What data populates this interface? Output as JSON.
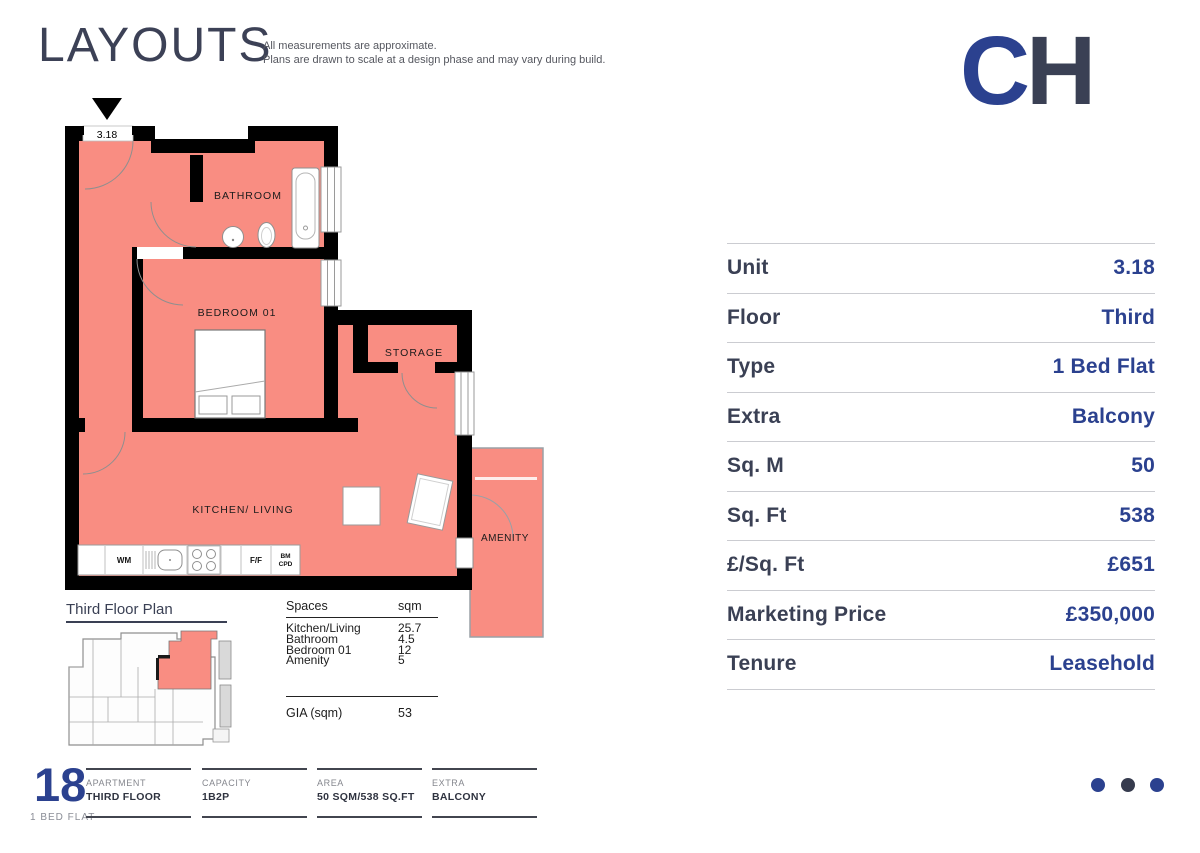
{
  "header": {
    "title": "LAYOUTS",
    "disclaimer_line1": "All measurements are approximate.",
    "disclaimer_line2": "Plans are drawn to scale at a design phase and may vary during build."
  },
  "logo": {
    "c": "C",
    "h": "H",
    "c_color": "#2B418F",
    "h_color": "#3A4054"
  },
  "plan": {
    "unit_label": "3.18",
    "fill_color": "#F98D82",
    "rooms": {
      "bathroom": "BATHROOM",
      "bedroom": "BEDROOM 01",
      "storage": "STORAGE",
      "kitchen": "KITCHEN/ LIVING",
      "amenity": "AMENITY"
    },
    "fixtures": {
      "wm": "WM",
      "ff": "F/F",
      "bm": "BM",
      "cpd": "CPD"
    }
  },
  "key_plan": {
    "title": "Third Floor Plan"
  },
  "spaces_table": {
    "header_label": "Spaces",
    "header_unit": "sqm",
    "rows": [
      {
        "name": "Kitchen/Living",
        "sqm": "25.7"
      },
      {
        "name": "Bathroom",
        "sqm": "4.5"
      },
      {
        "name": "Bedroom 01",
        "sqm": "12"
      },
      {
        "name": "Amenity",
        "sqm": "5"
      }
    ],
    "gia_label": "GIA (sqm)",
    "gia_value": "53"
  },
  "details_table": {
    "label_color": "#3A4054",
    "value_color": "#2B418F",
    "rows": [
      {
        "label": "Unit",
        "value": "3.18"
      },
      {
        "label": "Floor",
        "value": "Third"
      },
      {
        "label": "Type",
        "value": "1 Bed Flat"
      },
      {
        "label": "Extra",
        "value": "Balcony"
      },
      {
        "label": "Sq. M",
        "value": "50"
      },
      {
        "label": "Sq. Ft",
        "value": "538"
      },
      {
        "label": "£/Sq. Ft",
        "value": "£651"
      },
      {
        "label": "Marketing Price",
        "value": "£350,000"
      },
      {
        "label": "Tenure",
        "value": "Leasehold"
      }
    ]
  },
  "footer": {
    "number": "18",
    "flat_type": "1 BED FLAT",
    "sections": [
      {
        "label": "APARTMENT",
        "value": "THIRD FLOOR"
      },
      {
        "label": "CAPACITY",
        "value": "1B2P"
      },
      {
        "label": "AREA",
        "value": "50 SQM/538 SQ.FT"
      },
      {
        "label": "EXTRA",
        "value": "BALCONY"
      }
    ],
    "dot_colors": [
      "#2B418F",
      "#363B4E",
      "#2B418F"
    ]
  }
}
